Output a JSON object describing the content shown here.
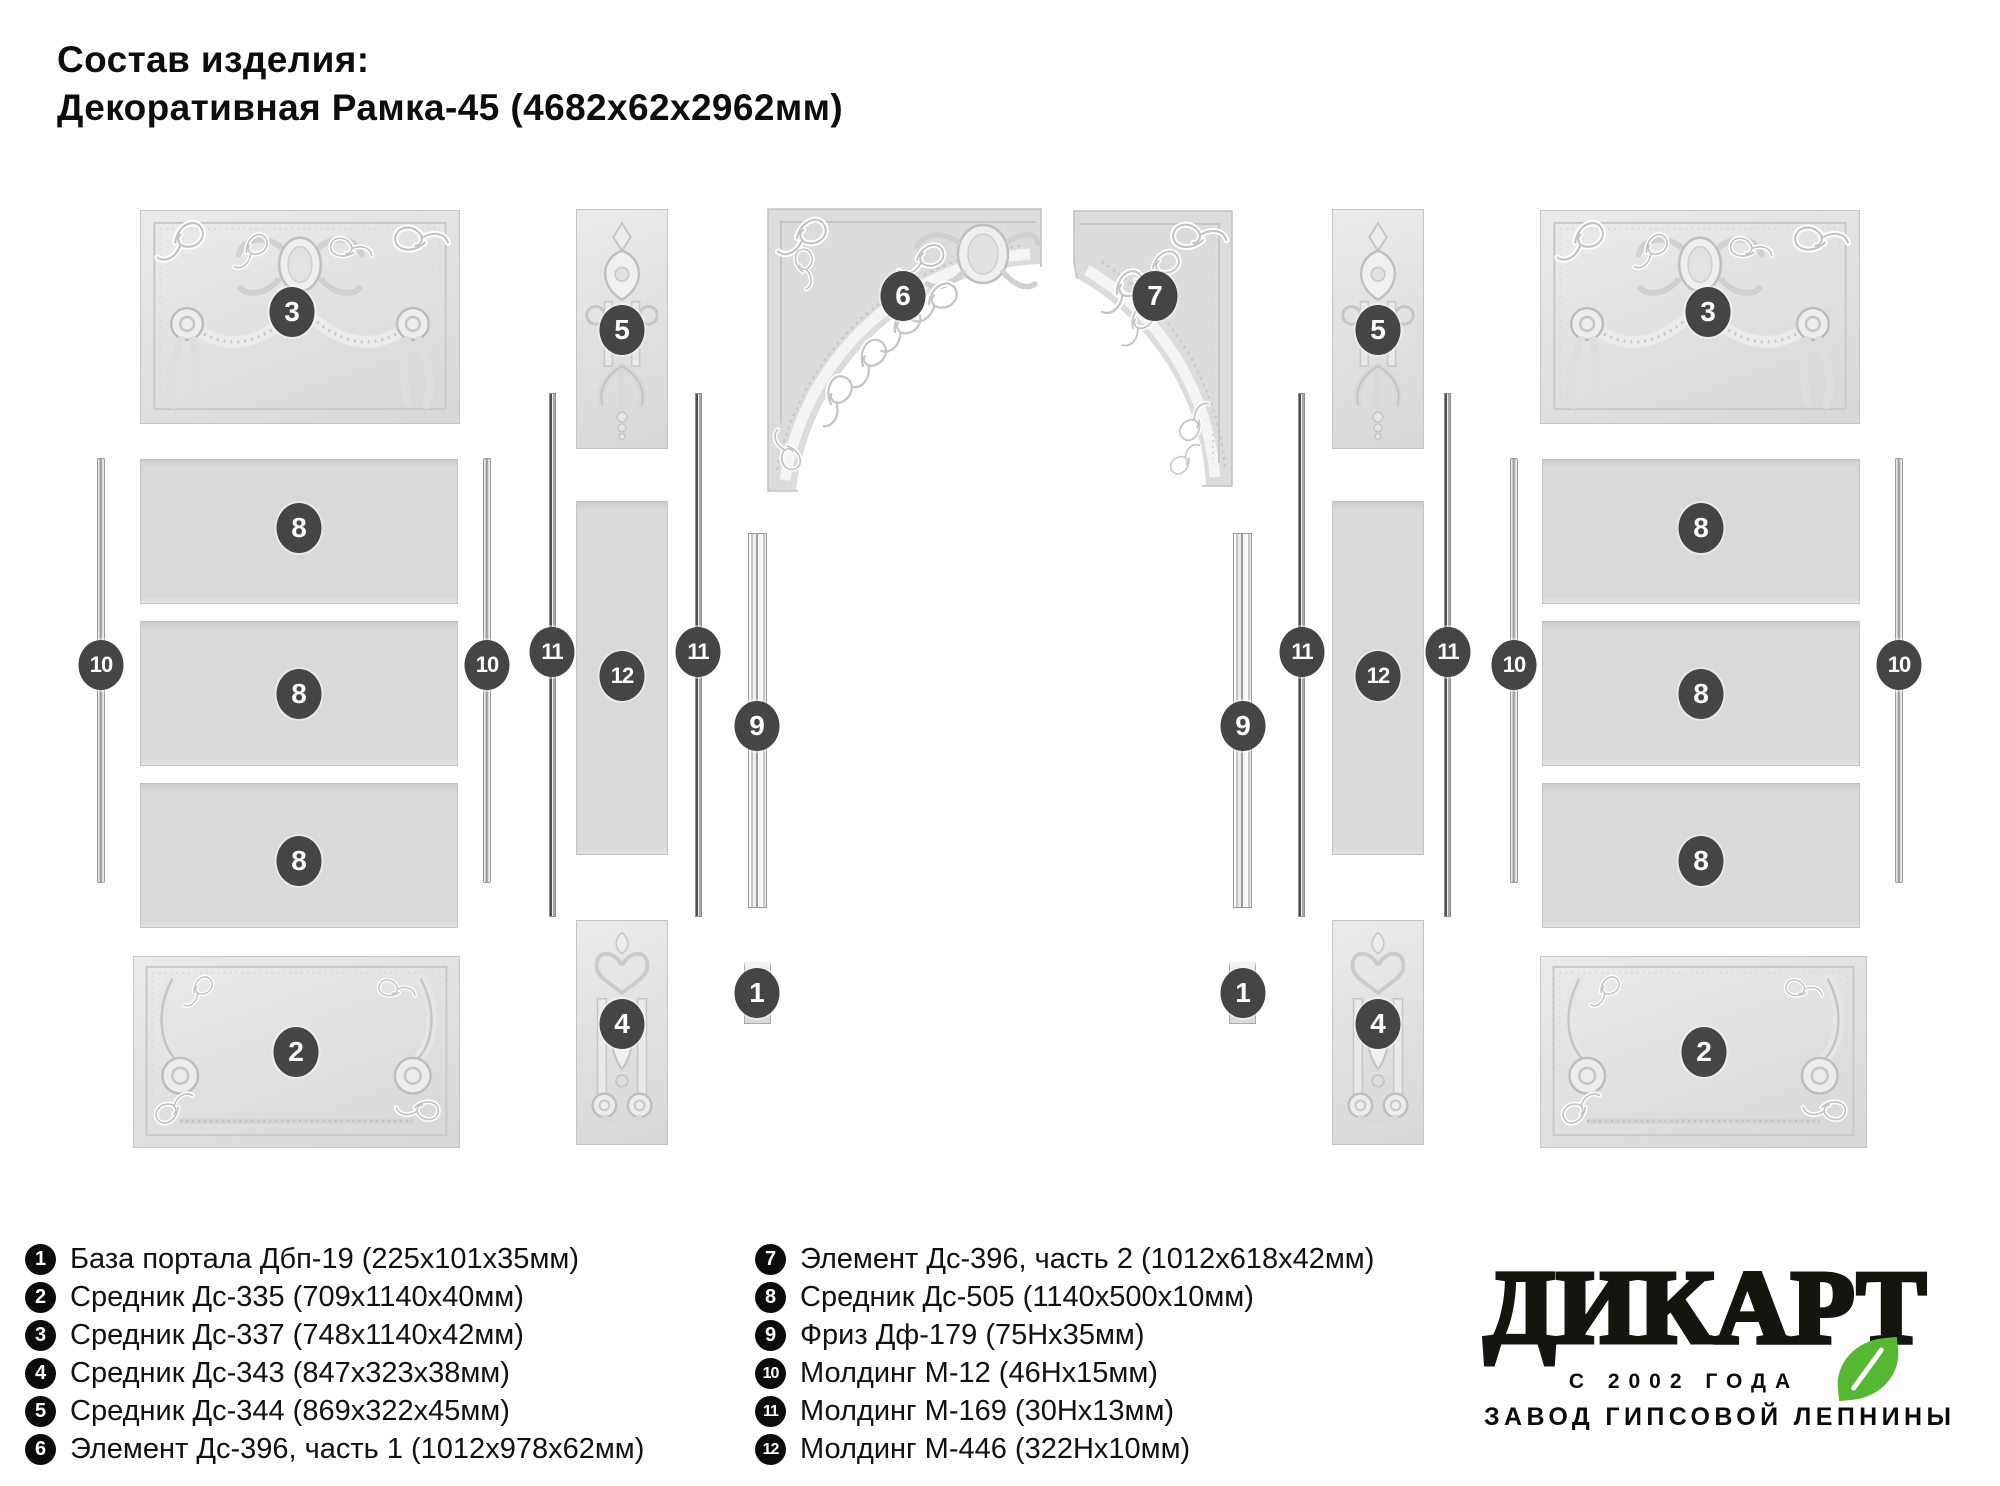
{
  "title": {
    "line1": "Состав изделия:",
    "line2": "Декоративная Рамка-45 (4682х62х2962мм)"
  },
  "legend": {
    "col1": [
      {
        "num": "1",
        "text": "База портала Дбп-19 (225х101х35мм)"
      },
      {
        "num": "2",
        "text": "Средник Дс-335 (709х1140х40мм)"
      },
      {
        "num": "3",
        "text": "Средник Дс-337 (748х1140х42мм)"
      },
      {
        "num": "4",
        "text": "Средник Дс-343 (847х323х38мм)"
      },
      {
        "num": "5",
        "text": "Средник Дс-344 (869х322х45мм)"
      },
      {
        "num": "6",
        "text": "Элемент Дс-396, часть 1 (1012х978х62мм)"
      }
    ],
    "col2": [
      {
        "num": "7",
        "text": "Элемент Дс-396, часть 2 (1012х618х42мм)"
      },
      {
        "num": "8",
        "text": "Средник Дс-505 (1140х500х10мм)"
      },
      {
        "num": "9",
        "text": "Фриз Дф-179 (75Нх35мм)"
      },
      {
        "num": "10",
        "text": "Молдинг М-12 (46Нх15мм)"
      },
      {
        "num": "11",
        "text": "Молдинг М-169 (30Нх13мм)"
      },
      {
        "num": "12",
        "text": "Молдинг М-446 (322Нх10мм)"
      }
    ]
  },
  "logo": {
    "wordmark": "ДИКАРТ",
    "tagline1": "С 2002 ГОДА",
    "tagline2": "ЗАВОД ГИПСОВОЙ ЛЕПНИНЫ",
    "leaf_color": "#56b832"
  },
  "diagram": {
    "badge_color": "#454545",
    "panels": [
      {
        "name": "panel-3-left",
        "type": "ornate-top",
        "x": 140,
        "y": 210,
        "w": 320,
        "h": 214
      },
      {
        "name": "panel-8-left-1",
        "type": "plain",
        "x": 140,
        "y": 459,
        "w": 318,
        "h": 145
      },
      {
        "name": "panel-8-left-2",
        "type": "plain",
        "x": 140,
        "y": 621,
        "w": 318,
        "h": 145
      },
      {
        "name": "panel-8-left-3",
        "type": "plain",
        "x": 140,
        "y": 783,
        "w": 318,
        "h": 145
      },
      {
        "name": "panel-2-left",
        "type": "ornate-bottom",
        "x": 133,
        "y": 956,
        "w": 327,
        "h": 192
      },
      {
        "name": "molding-10-a",
        "type": "molding",
        "x": 97,
        "y": 458,
        "w": 8,
        "h": 425
      },
      {
        "name": "molding-10-b",
        "type": "molding",
        "x": 483,
        "y": 458,
        "w": 8,
        "h": 425
      },
      {
        "name": "panel-5-left",
        "type": "drop",
        "x": 576,
        "y": 209,
        "w": 92,
        "h": 240
      },
      {
        "name": "molding-11-a",
        "type": "molding2",
        "x": 549,
        "y": 393,
        "w": 7,
        "h": 524
      },
      {
        "name": "molding-11-b",
        "type": "molding2",
        "x": 695,
        "y": 393,
        "w": 7,
        "h": 524
      },
      {
        "name": "panel-12-left",
        "type": "plain",
        "x": 576,
        "y": 501,
        "w": 92,
        "h": 354
      },
      {
        "name": "panel-4-left",
        "type": "drop2",
        "x": 576,
        "y": 920,
        "w": 92,
        "h": 225
      },
      {
        "name": "element-6",
        "type": "arch-left",
        "x": 767,
        "y": 208,
        "w": 275,
        "h": 284
      },
      {
        "name": "element-7",
        "type": "arch-right",
        "x": 1073,
        "y": 210,
        "w": 160,
        "h": 277
      },
      {
        "name": "frieze-9-left",
        "type": "frieze",
        "x": 748,
        "y": 533,
        "w": 19,
        "h": 375
      },
      {
        "name": "frieze-9-right",
        "type": "frieze",
        "x": 1233,
        "y": 533,
        "w": 19,
        "h": 375
      },
      {
        "name": "base-1-left",
        "type": "base",
        "x": 744,
        "y": 962,
        "w": 27,
        "h": 62
      },
      {
        "name": "base-1-right",
        "type": "base",
        "x": 1229,
        "y": 962,
        "w": 27,
        "h": 62
      },
      {
        "name": "molding-11-c",
        "type": "molding2",
        "x": 1298,
        "y": 393,
        "w": 7,
        "h": 524
      },
      {
        "name": "molding-11-d",
        "type": "molding2",
        "x": 1444,
        "y": 393,
        "w": 7,
        "h": 524
      },
      {
        "name": "panel-5-right",
        "type": "drop",
        "x": 1332,
        "y": 209,
        "w": 92,
        "h": 240
      },
      {
        "name": "panel-12-right",
        "type": "plain",
        "x": 1332,
        "y": 501,
        "w": 92,
        "h": 354
      },
      {
        "name": "panel-4-right",
        "type": "drop2",
        "x": 1332,
        "y": 920,
        "w": 92,
        "h": 225
      },
      {
        "name": "molding-10-c",
        "type": "molding",
        "x": 1510,
        "y": 458,
        "w": 8,
        "h": 425
      },
      {
        "name": "molding-10-d",
        "type": "molding",
        "x": 1895,
        "y": 458,
        "w": 8,
        "h": 425
      },
      {
        "name": "panel-3-right",
        "type": "ornate-top",
        "x": 1540,
        "y": 210,
        "w": 320,
        "h": 214
      },
      {
        "name": "panel-8-right-1",
        "type": "plain",
        "x": 1542,
        "y": 459,
        "w": 318,
        "h": 145
      },
      {
        "name": "panel-8-right-2",
        "type": "plain",
        "x": 1542,
        "y": 621,
        "w": 318,
        "h": 145
      },
      {
        "name": "panel-8-right-3",
        "type": "plain",
        "x": 1542,
        "y": 783,
        "w": 318,
        "h": 145
      },
      {
        "name": "panel-2-right",
        "type": "ornate-bottom",
        "x": 1540,
        "y": 956,
        "w": 327,
        "h": 192
      }
    ],
    "badges": [
      {
        "label": "3",
        "x": 292,
        "y": 312
      },
      {
        "label": "3",
        "x": 1708,
        "y": 312
      },
      {
        "label": "8",
        "x": 299,
        "y": 528
      },
      {
        "label": "8",
        "x": 299,
        "y": 694
      },
      {
        "label": "8",
        "x": 299,
        "y": 861
      },
      {
        "label": "8",
        "x": 1701,
        "y": 528
      },
      {
        "label": "8",
        "x": 1701,
        "y": 694
      },
      {
        "label": "8",
        "x": 1701,
        "y": 861
      },
      {
        "label": "2",
        "x": 296,
        "y": 1052
      },
      {
        "label": "2",
        "x": 1704,
        "y": 1052
      },
      {
        "label": "10",
        "x": 101,
        "y": 665
      },
      {
        "label": "10",
        "x": 487,
        "y": 665
      },
      {
        "label": "10",
        "x": 1514,
        "y": 665
      },
      {
        "label": "10",
        "x": 1899,
        "y": 665
      },
      {
        "label": "11",
        "x": 552,
        "y": 652
      },
      {
        "label": "11",
        "x": 698,
        "y": 652
      },
      {
        "label": "11",
        "x": 1302,
        "y": 652
      },
      {
        "label": "11",
        "x": 1448,
        "y": 652
      },
      {
        "label": "5",
        "x": 622,
        "y": 330
      },
      {
        "label": "5",
        "x": 1378,
        "y": 330
      },
      {
        "label": "12",
        "x": 622,
        "y": 676
      },
      {
        "label": "12",
        "x": 1378,
        "y": 676
      },
      {
        "label": "4",
        "x": 622,
        "y": 1024
      },
      {
        "label": "4",
        "x": 1378,
        "y": 1024
      },
      {
        "label": "6",
        "x": 903,
        "y": 296
      },
      {
        "label": "7",
        "x": 1155,
        "y": 296
      },
      {
        "label": "9",
        "x": 757,
        "y": 726
      },
      {
        "label": "9",
        "x": 1243,
        "y": 726
      },
      {
        "label": "1",
        "x": 757,
        "y": 993
      },
      {
        "label": "1",
        "x": 1243,
        "y": 993
      }
    ]
  }
}
